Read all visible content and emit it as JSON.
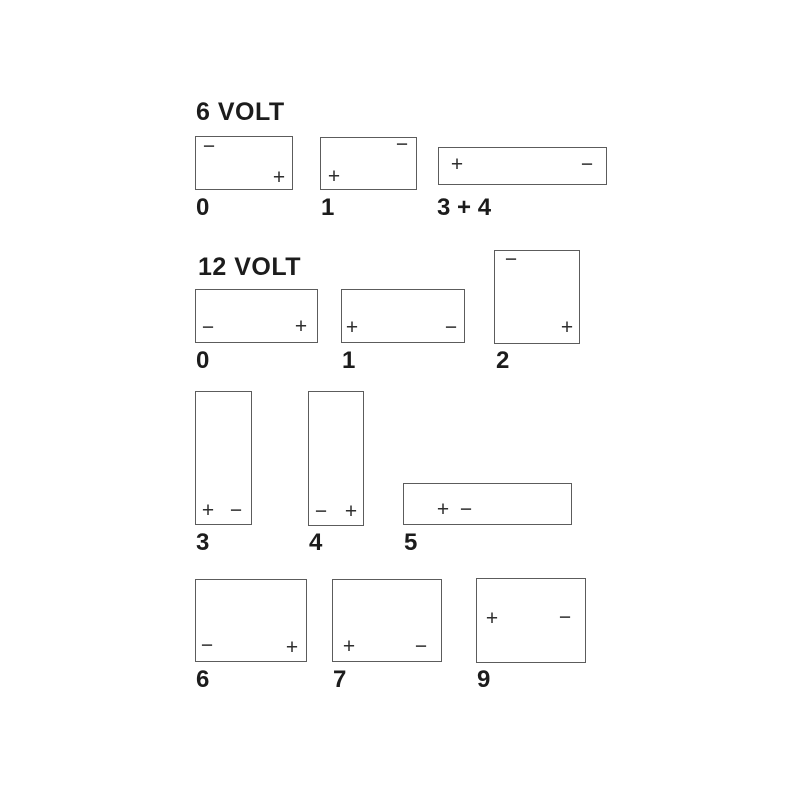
{
  "diagram_title": "Battery terminal layout diagram",
  "colors": {
    "background": "#ffffff",
    "box_border": "#5c5c5c",
    "text": "#1c1c1c",
    "terminal_sign": "#2e2e2e"
  },
  "sections": [
    {
      "heading": "6 VOLT",
      "batteries": [
        {
          "label": "0",
          "terminals": [
            {
              "sign": "−",
              "position": "top-left"
            },
            {
              "sign": "+",
              "position": "bottom-right"
            }
          ]
        },
        {
          "label": "1",
          "terminals": [
            {
              "sign": "−",
              "position": "top-right"
            },
            {
              "sign": "+",
              "position": "bottom-left"
            }
          ]
        },
        {
          "label": "3 + 4",
          "terminals": [
            {
              "sign": "+",
              "position": "middle-left"
            },
            {
              "sign": "−",
              "position": "middle-right"
            }
          ]
        }
      ]
    },
    {
      "heading": "12 VOLT",
      "batteries": [
        {
          "label": "0",
          "terminals": [
            {
              "sign": "−",
              "position": "bottom-left"
            },
            {
              "sign": "+",
              "position": "bottom-right"
            }
          ]
        },
        {
          "label": "1",
          "terminals": [
            {
              "sign": "+",
              "position": "bottom-left"
            },
            {
              "sign": "−",
              "position": "bottom-right"
            }
          ]
        },
        {
          "label": "2",
          "terminals": [
            {
              "sign": "−",
              "position": "top-left"
            },
            {
              "sign": "+",
              "position": "bottom-right"
            }
          ]
        },
        {
          "label": "3",
          "terminals": [
            {
              "sign": "+",
              "position": "bottom-left"
            },
            {
              "sign": "−",
              "position": "bottom-right"
            }
          ]
        },
        {
          "label": "4",
          "terminals": [
            {
              "sign": "−",
              "position": "bottom-left"
            },
            {
              "sign": "+",
              "position": "bottom-right"
            }
          ]
        },
        {
          "label": "5",
          "terminals": [
            {
              "sign": "+",
              "position": "middle-left"
            },
            {
              "sign": "−",
              "position": "middle-left-adjacent"
            }
          ]
        },
        {
          "label": "6",
          "terminals": [
            {
              "sign": "−",
              "position": "bottom-left"
            },
            {
              "sign": "+",
              "position": "bottom-right"
            }
          ]
        },
        {
          "label": "7",
          "terminals": [
            {
              "sign": "+",
              "position": "bottom-left"
            },
            {
              "sign": "−",
              "position": "bottom-right"
            }
          ]
        },
        {
          "label": "9",
          "terminals": [
            {
              "sign": "+",
              "position": "upper-left"
            },
            {
              "sign": "−",
              "position": "upper-right"
            }
          ]
        }
      ]
    }
  ]
}
